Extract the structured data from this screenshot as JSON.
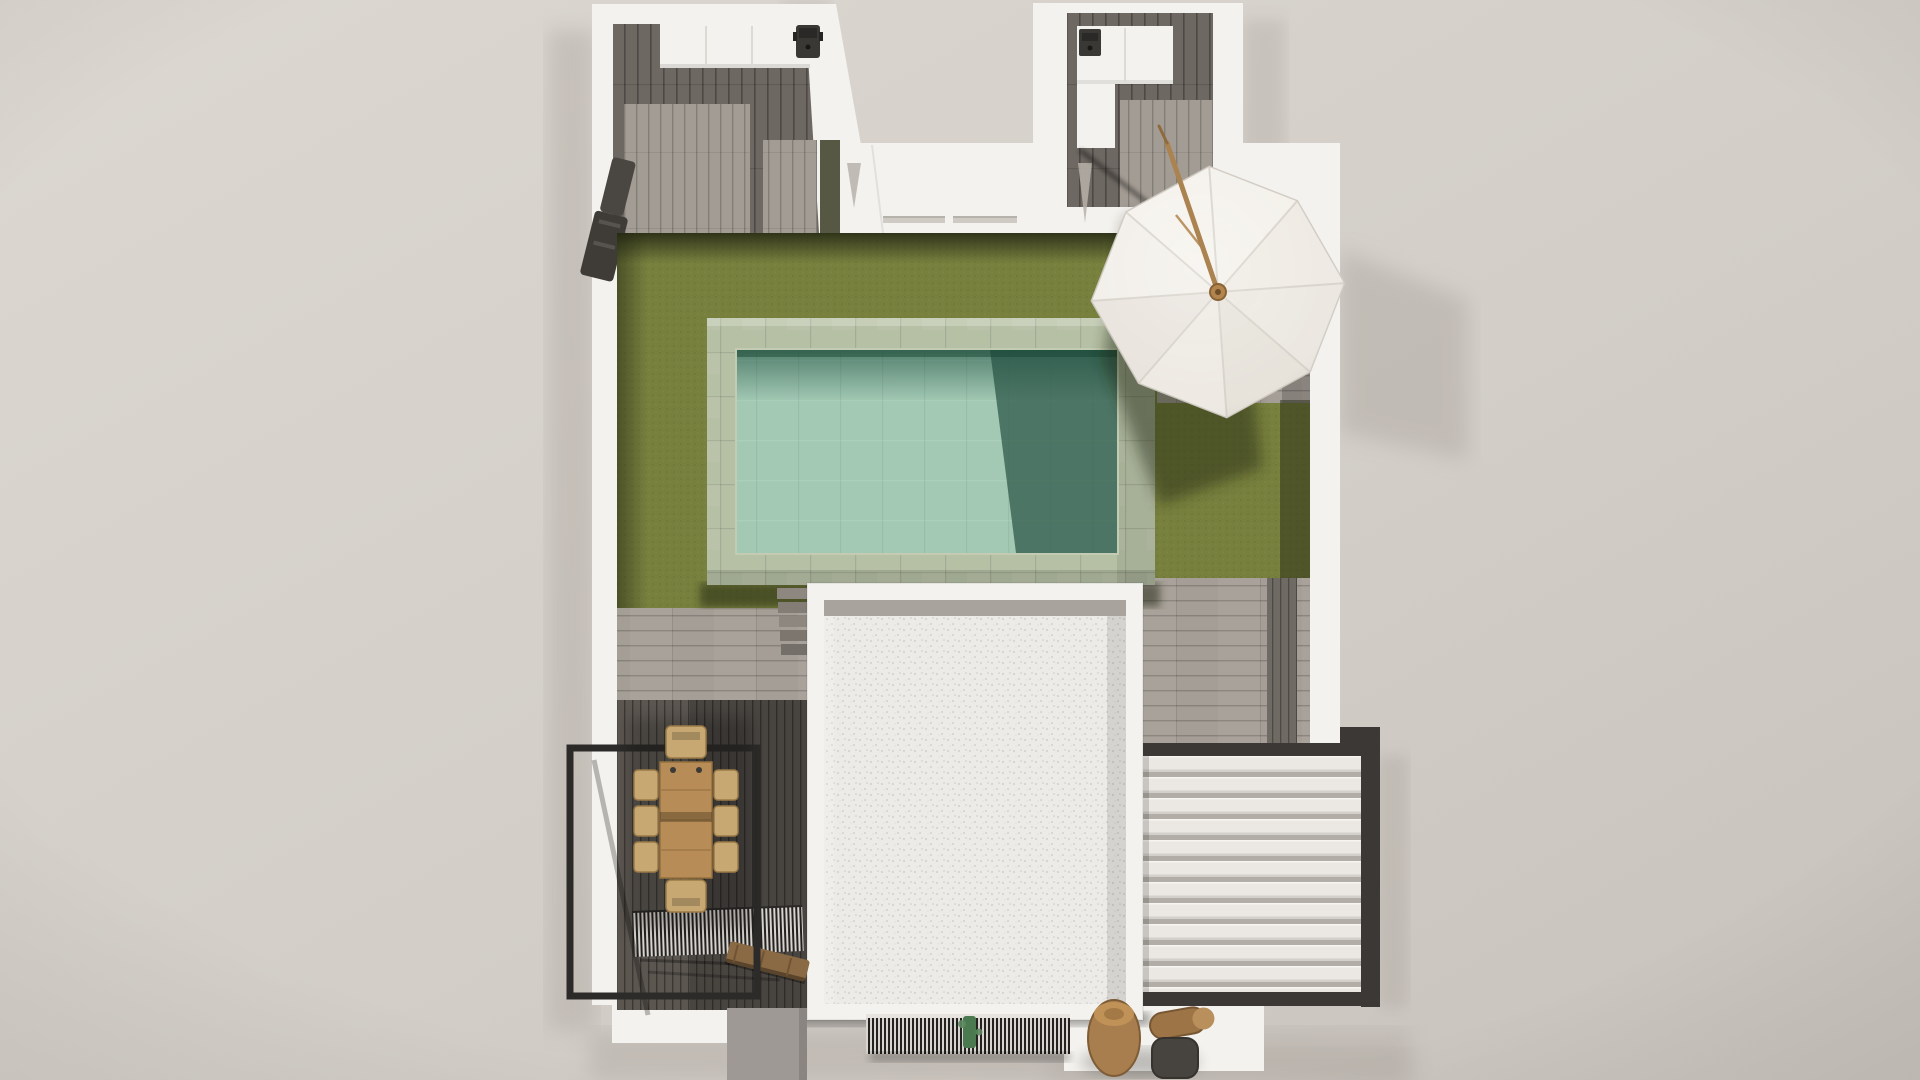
{
  "scene": {
    "kind": "top-down 3D architectural render",
    "subject": "villa plot with U-shaped house, garden, pool, parasol, roof terrace, dining deck and louvered pergola",
    "objects": [
      {
        "name": "left-wing-patio",
        "desc": "open patio with dark wood floor and outdoor kitchen counter with BBQ grill"
      },
      {
        "name": "right-wing-patio",
        "desc": "open patio with dark wood floor and L-shaped counter with small appliance"
      },
      {
        "name": "entry-court",
        "desc": "open forecourt between wings"
      },
      {
        "name": "north-wall",
        "desc": "white wall band with two recessed planter strips"
      },
      {
        "name": "lawn",
        "desc": "olive green artificial grass"
      },
      {
        "name": "pool",
        "desc": "rectangular pool with sage stone deck and teal water, partly in shadow"
      },
      {
        "name": "pool-steps",
        "desc": "five gray steps beside pool"
      },
      {
        "name": "parasol",
        "desc": "white 8-panel umbrella with tilted wooden pole on gray paved terrace"
      },
      {
        "name": "building-roof",
        "desc": "white gravel flat roof with parapet"
      },
      {
        "name": "dining-set",
        "desc": "wood table, six side chairs, two head chairs on dark deck"
      },
      {
        "name": "balcony-railing",
        "desc": "black metal railing frame over lower patio void"
      },
      {
        "name": "slatted-grate-left",
        "desc": "dark slat grate over stair void with wooden bench"
      },
      {
        "name": "entry-grate",
        "desc": "fine slat grate at entrance with green plant stem"
      },
      {
        "name": "louvered-pergola",
        "desc": "white louver canopy with dark metal frame, bottom right"
      },
      {
        "name": "log-stools",
        "desc": "wooden log stools and dark pouf near entrance"
      }
    ]
  },
  "palette": {
    "bg1": "#dcd7d1",
    "bg2": "#d3cec8",
    "bg3": "#c8c2bc",
    "wallWhite": "#f4f2ee",
    "wallShade": "#e2dfda",
    "roofBase": "#edebe7",
    "roofDot": "#d7d4cf",
    "parapet": "#a8a39d",
    "floorDark": "#6e6862",
    "floorLight": "#a39c94",
    "paving": "#a59e96",
    "deckDark": "#5b5650",
    "stripDark": "#6f6a64",
    "lawn": "#78803e",
    "lawnShadow": "#1d2110",
    "poolDeck": "#b6c0a5",
    "waterLight": "#a3c9b4",
    "waterDark": "#355e4e",
    "stepGray": "#8d8780",
    "railBlack": "#2d2b29",
    "louverWhite": "#ebe8e3",
    "louverGap": "#b2ada6",
    "louverFrame": "#3b3835",
    "grateDark": "#232220",
    "grateBg": "#d8d4cf",
    "stemGreen": "#4c7a50",
    "woodTable": "#b78c56",
    "woodChair": "#c7a873",
    "woodBench": "#8a6a44",
    "woodLog": "#a87e4e",
    "poufDark": "#47433f",
    "umbLight": "#f4f1eb",
    "umbSeam": "#d7d2ca",
    "umbPole": "#ab8351",
    "applianceDark": "#3a3835",
    "shadowSoft": "#b3ada6"
  }
}
